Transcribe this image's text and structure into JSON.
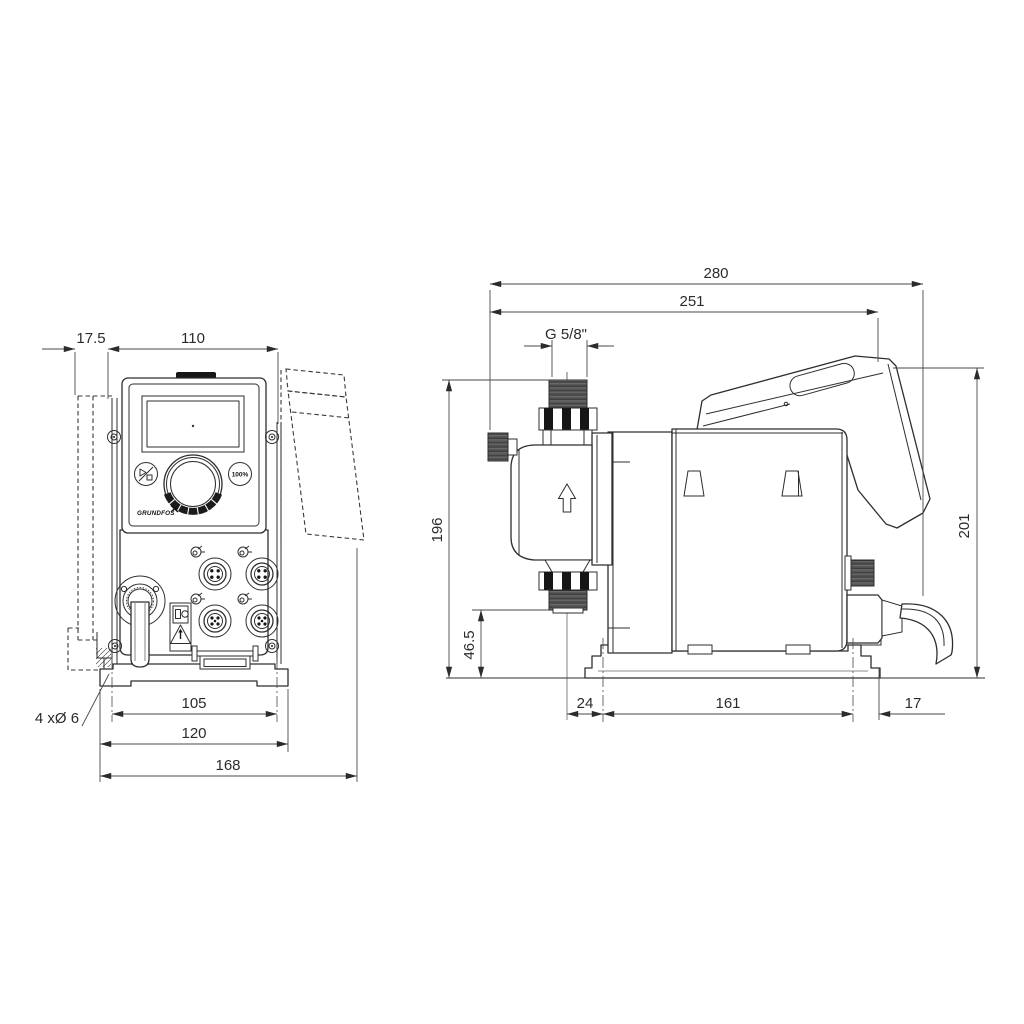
{
  "colors": {
    "line": "#2e2e2e",
    "dim_line": "#4a4a4a",
    "background": "#ffffff"
  },
  "front_view": {
    "labels": {
      "hole_note": "4 xØ 6",
      "button_100": "100%",
      "logo": "GRUNDFOS"
    },
    "dims": {
      "plate_thickness": "17.5",
      "panel_width": "110",
      "hole_spacing": "105",
      "base_width": "120",
      "overall_width": "168"
    },
    "icons": {
      "start_stop": "play-stop",
      "io_ports": "io-port",
      "power": "power-plug",
      "warning": "warning-triangle"
    }
  },
  "side_view": {
    "dims": {
      "overall_depth": "280",
      "depth_to_control_cube": "251",
      "connection_thread": "G 5/8\"",
      "inlet_height": "196",
      "outlet_height": "46.5",
      "overall_height": "201",
      "base_front_offset": "24",
      "base_hole_spacing": "161",
      "base_rear_offset": "17"
    },
    "icons": {
      "flow_direction": "arrow-up"
    }
  }
}
